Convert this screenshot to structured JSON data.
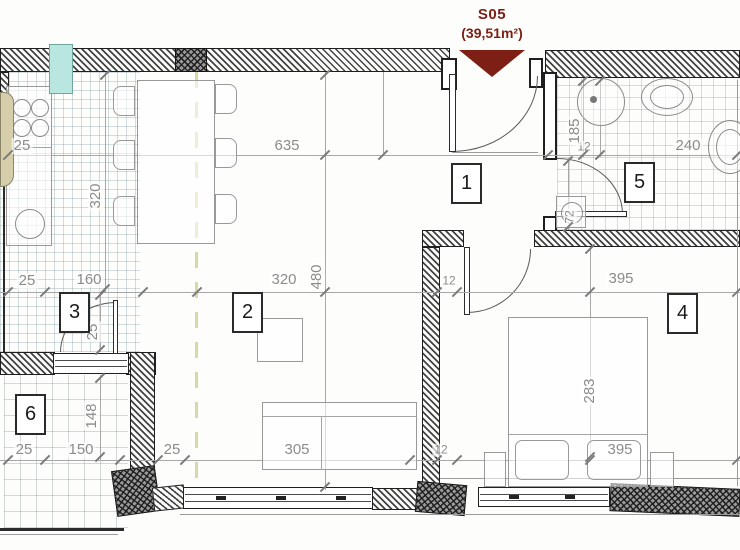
{
  "header": {
    "unit_id": "S05",
    "area_label": "(39,51m²)"
  },
  "legend": {
    "entrance_marker": "entrance-arrow-down"
  },
  "room_labels": [
    "1",
    "2",
    "3",
    "4",
    "5",
    "6"
  ],
  "dimension_labels": [
    "25",
    "635",
    "12",
    "240",
    "25",
    "160",
    "320",
    "12",
    "395",
    "25",
    "150",
    "25",
    "305",
    "12",
    "395",
    "320",
    "480",
    "185",
    "72",
    "25",
    "148",
    "283"
  ],
  "colors": {
    "accent_maroon": "#7d1f15",
    "dimension_text": "#8b8b8b",
    "wall_line": "#1f1f1f",
    "zone_dash": "#d9d9a8",
    "glass_teal": "#b9e6df",
    "tan_fill": "#d6cdaa"
  }
}
